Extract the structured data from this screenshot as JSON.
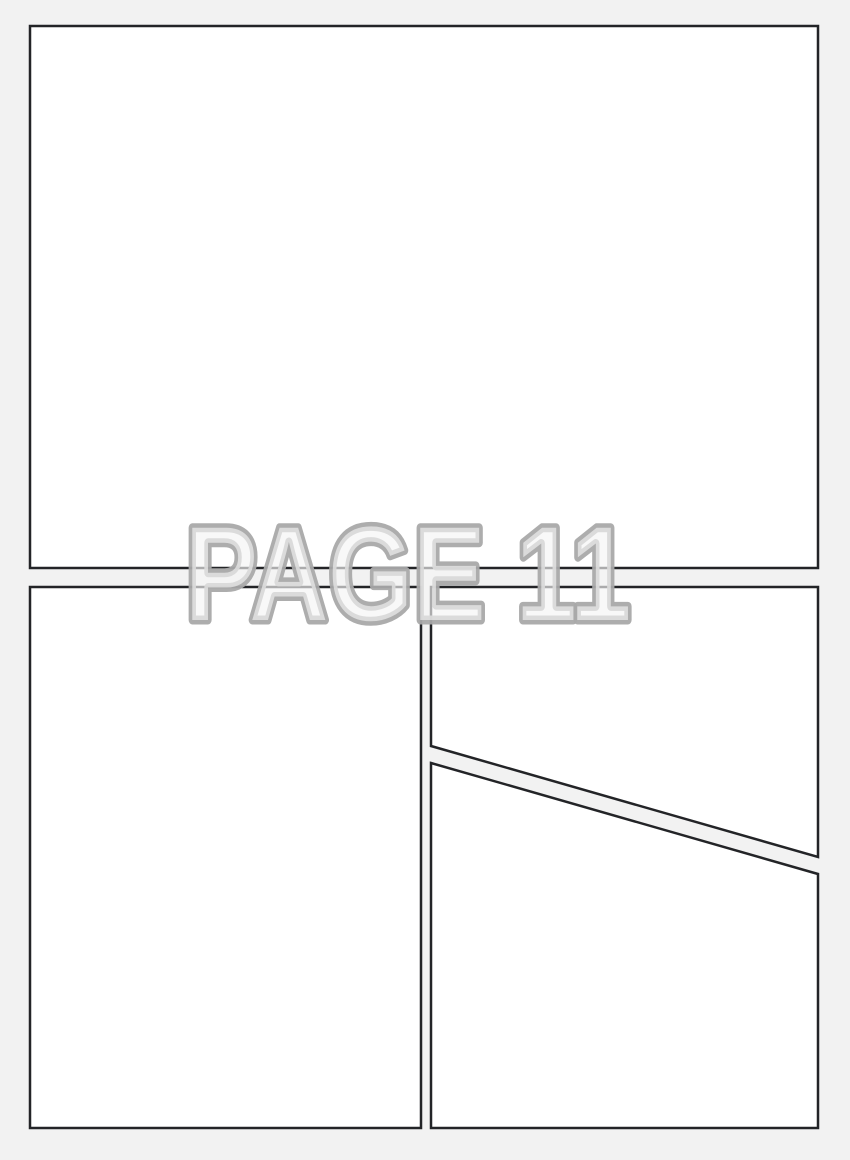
{
  "page": {
    "watermark": "PAGE 11",
    "panel_count": 4
  },
  "colors": {
    "page_background": "#f2f2f2",
    "panel_fill": "#ffffff",
    "panel_border": "#232427",
    "watermark_fill": "#f5f5f5",
    "watermark_outline": "#a9a9a9"
  }
}
